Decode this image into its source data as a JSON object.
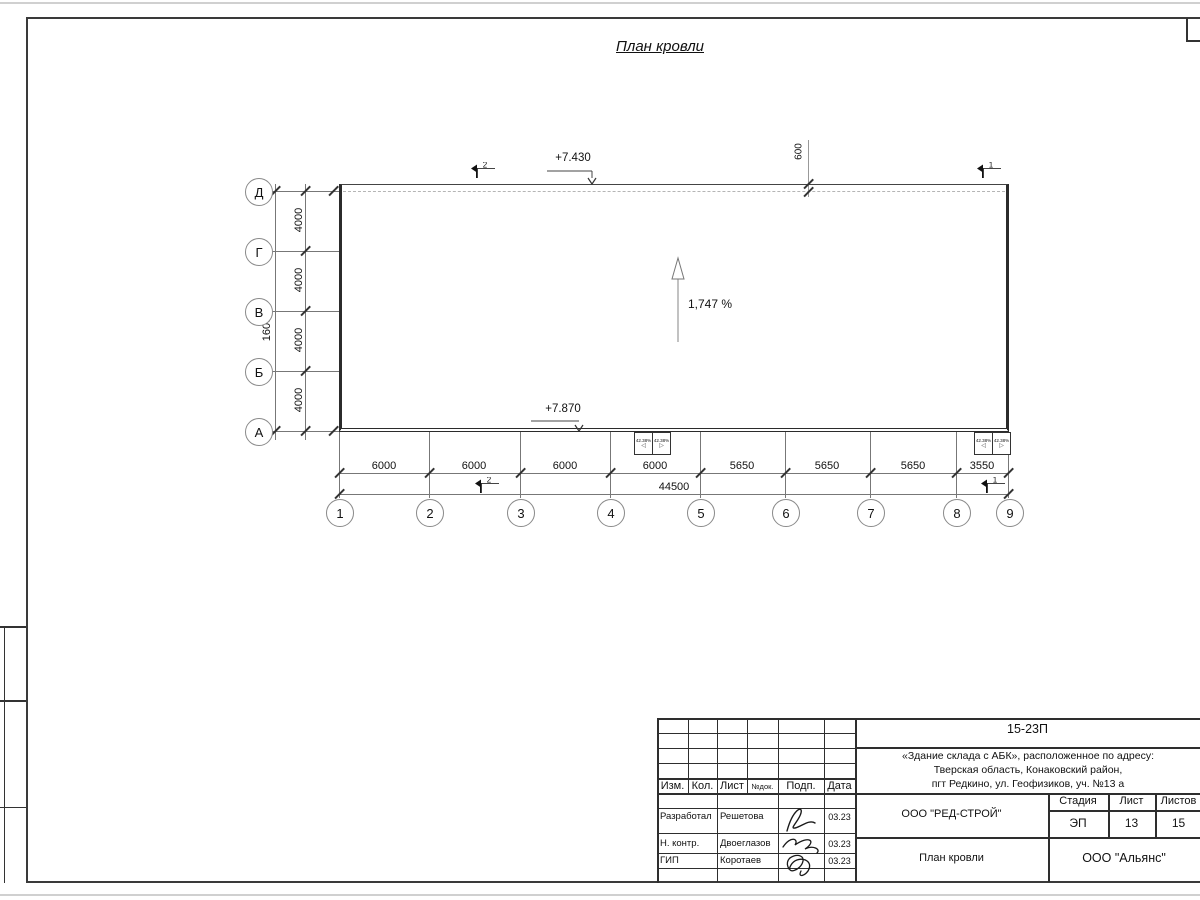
{
  "page": {
    "title": "План кровли"
  },
  "drawing": {
    "elevation_top": "+7.430",
    "elevation_bottom": "+7.870",
    "slope": "1,747 %",
    "parapet_offset": "600",
    "funnel_slope": "42.38%",
    "funnel_arrow_left": "◁",
    "funnel_arrow_right": "▷",
    "section_marks": {
      "s1": "1",
      "s2": "2"
    },
    "axes": {
      "rows": [
        "Д",
        "Г",
        "В",
        "Б",
        "А"
      ],
      "cols": [
        "1",
        "2",
        "3",
        "4",
        "5",
        "6",
        "7",
        "8",
        "9"
      ]
    },
    "dims": {
      "left_segments": [
        "4000",
        "4000",
        "4000",
        "4000"
      ],
      "left_total": "16000",
      "bottom_segments": [
        "6000",
        "6000",
        "6000",
        "6000",
        "5650",
        "5650",
        "5650",
        "3550"
      ],
      "bottom_total": "44500"
    }
  },
  "title_block": {
    "doc_number": "15-23П",
    "address_line1": "«Здание склада с АБК», расположенное по адресу:",
    "address_line2": "Тверская область, Конаковский район,",
    "address_line3": "пгт Редкино, ул. Геофизиков, уч. №13 а",
    "company": "ООО \"РЕД-СТРОЙ\"",
    "sheet_title": "План кровли",
    "contractor": "ООО \"Альянс\"",
    "headers": {
      "izm": "Изм.",
      "kol": "Кол.",
      "list": "Лист",
      "doc": "№док.",
      "podp": "Подп.",
      "data": "Дата",
      "stage": "Стадия",
      "sheet": "Лист",
      "sheets": "Листов"
    },
    "stage_value": "ЭП",
    "sheet_value": "13",
    "sheets_value": "15",
    "rows": [
      {
        "role": "Разработал",
        "name": "Решетова",
        "date": "03.23"
      },
      {
        "role": "Н. контр.",
        "name": "Двоеглазов",
        "date": "03.23"
      },
      {
        "role": "ГИП",
        "name": "Коротаев",
        "date": "03.23"
      }
    ]
  },
  "colors": {
    "line": "#333333",
    "dashed_parapet": "#b5b5b5",
    "paper_edge": "#d0d0d0"
  }
}
